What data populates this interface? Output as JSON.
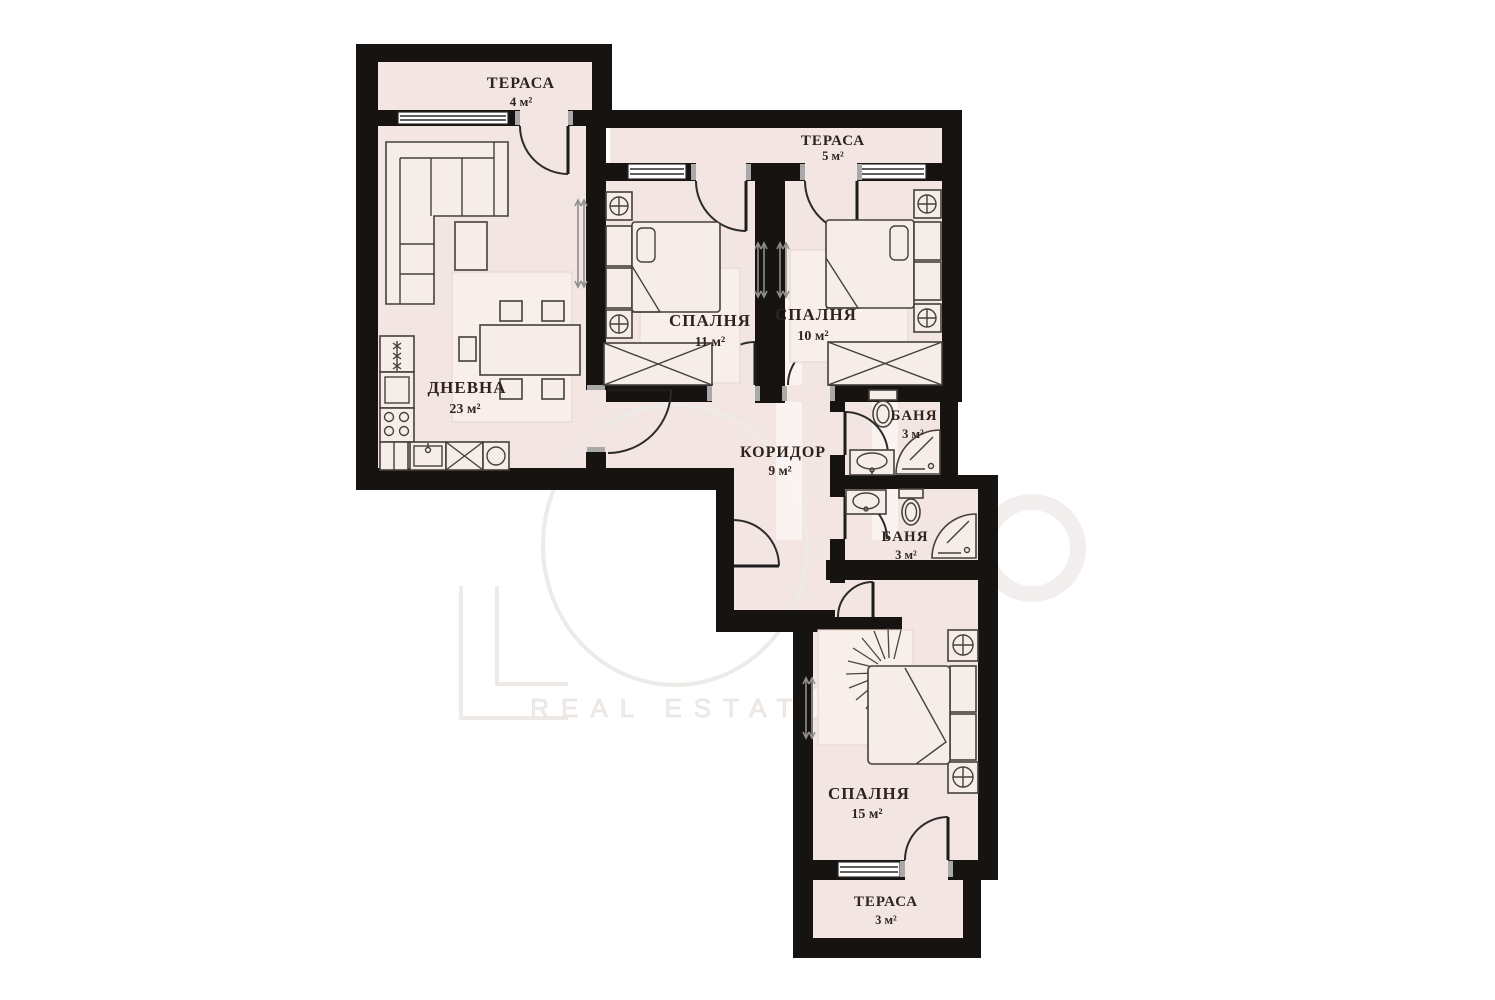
{
  "plan": {
    "type": "apartment-floor-plan",
    "language": "bg",
    "rooms": {
      "terrace_top_left": {
        "name": "ТЕРАСА",
        "area": "4 м²"
      },
      "living_room": {
        "name": "ДНЕВНА",
        "area": "23 м²"
      },
      "terrace_top": {
        "name": "ТЕРАСА",
        "area": "5 м²"
      },
      "bedroom_11": {
        "name": "СПАЛНЯ",
        "area": "11 м²"
      },
      "bedroom_10": {
        "name": "СПАЛНЯ",
        "area": "10 м²"
      },
      "corridor": {
        "name": "КОРИДОР",
        "area": "9 м²"
      },
      "bathroom_upper": {
        "name": "БАНЯ",
        "area": "3 м²"
      },
      "bathroom_lower": {
        "name": "БАНЯ",
        "area": "3 м²"
      },
      "bedroom_15": {
        "name": "СПАЛНЯ",
        "area": "15 м²"
      },
      "terrace_bottom": {
        "name": "ТЕРАСА",
        "area": "3 м²"
      }
    },
    "icons": [
      "corner-sofa",
      "coffee-table",
      "dining-table",
      "chair",
      "fridge",
      "kitchen-cabinet",
      "stove",
      "kitchen-sink",
      "double-bed",
      "nightstand",
      "wardrobe",
      "toilet",
      "washbasin",
      "corner-shower",
      "radiator",
      "door-swing",
      "window",
      "plant-fan"
    ],
    "colors": {
      "background": "#ffffff",
      "floor": "#f3e5e1",
      "wall": "#171310",
      "furniture_line": "#45403b",
      "label_text": "#2f231c",
      "watermark": "#edeae8"
    }
  },
  "watermark": {
    "brand_text": "REAL ESTATE"
  }
}
